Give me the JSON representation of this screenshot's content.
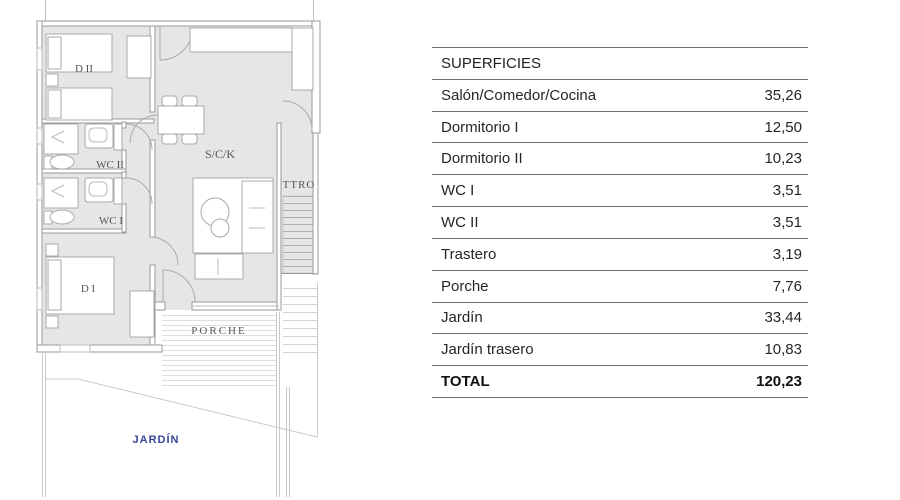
{
  "plan": {
    "labels": {
      "bedroom2": "D II",
      "wc2": "WC II",
      "wc1": "WC I",
      "bedroom1": "D I",
      "living": "S/C/K",
      "storage": "TTRO",
      "porch": "PORCHE",
      "garden": "JARDÍN"
    },
    "colors": {
      "room_fill": "#e6e6e6",
      "wall_line": "#9a9a9a",
      "label_text": "#555555",
      "garden_text": "#36479c"
    }
  },
  "table": {
    "header": "SUPERFICIES",
    "rows": [
      {
        "label": "Salón/Comedor/Cocina",
        "value": "35,26"
      },
      {
        "label": "Dormitorio I",
        "value": "12,50"
      },
      {
        "label": "Dormitorio II",
        "value": "10,23"
      },
      {
        "label": "WC I",
        "value": "3,51"
      },
      {
        "label": "WC II",
        "value": "3,51"
      },
      {
        "label": "Trastero",
        "value": "3,19"
      },
      {
        "label": "Porche",
        "value": "7,76"
      },
      {
        "label": "Jardín",
        "value": "33,44"
      },
      {
        "label": "Jardín trasero",
        "value": "10,83"
      }
    ],
    "total": {
      "label": "TOTAL",
      "value": "120,23"
    }
  }
}
